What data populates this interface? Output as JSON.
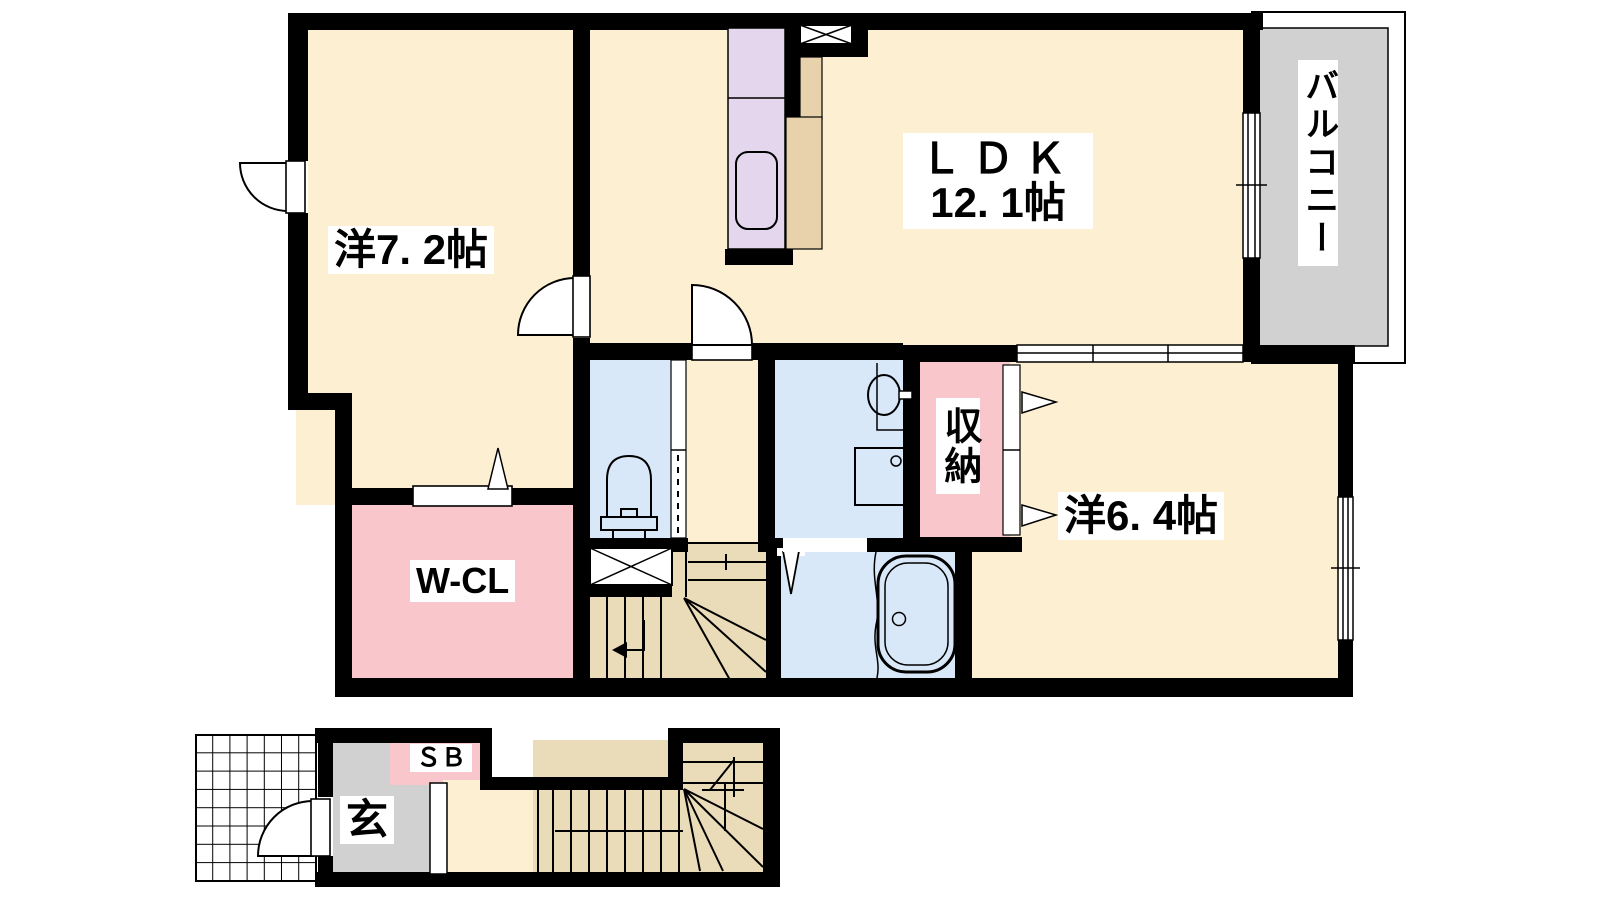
{
  "floorplan": {
    "type": "japanese-apartment-floorplan-2F",
    "rooms": {
      "west_room_1": "洋7. 2帖",
      "ldk_line1": "ＬＤＫ",
      "ldk_line2": "12. 1帖",
      "west_room_2": "洋6. 4帖",
      "balcony": "バルコニー",
      "storage": "収納",
      "walk_in_closet": "W-CL",
      "entrance": "玄",
      "shoe_box": "ＳＢ"
    },
    "colors": {
      "wall": "#000000",
      "room-cream": "#FCEFD2",
      "room-pink": "#F9C7CB",
      "room-blue": "#D8E8F8",
      "room-tan": "#EADCB8",
      "counter-tan": "#E7D2AC",
      "room-lavender": "#E3D6ED",
      "room-gray": "#D1D1D1",
      "porch-white": "#FFFFFF"
    }
  }
}
